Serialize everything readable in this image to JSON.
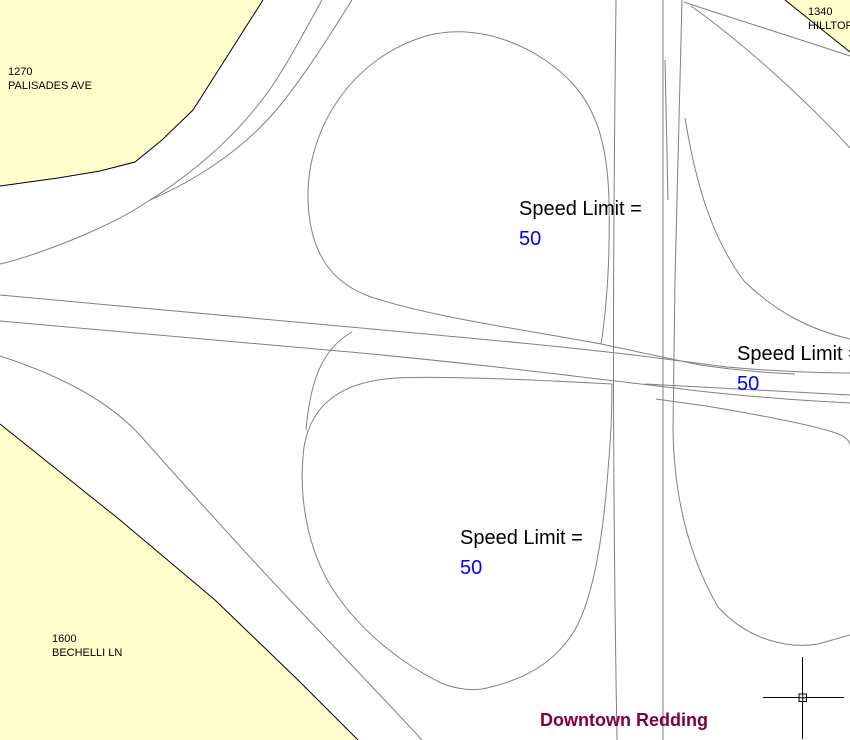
{
  "map_title": "Downtown Redding",
  "parcels": [
    {
      "number": "1270",
      "street": "PALISADES AVE"
    },
    {
      "number": "1340",
      "street": "HILLTOP"
    },
    {
      "number": "1600",
      "street": "BECHELLI LN"
    }
  ],
  "speed_labels": [
    {
      "label": "Speed Limit =",
      "value": "50"
    },
    {
      "label": "Speed Limit =",
      "value": "50"
    },
    {
      "label": "Speed Limit =",
      "value": "50"
    }
  ],
  "colors": {
    "background": "#FFFFFF",
    "parcel_fill": "#FFFFCC",
    "parcel_border": "#000000",
    "road_line": "#808080",
    "speed_label_text": "#000000",
    "speed_value_text": "#0000FF",
    "title_text": "#800040",
    "crosshair": "#000000"
  }
}
